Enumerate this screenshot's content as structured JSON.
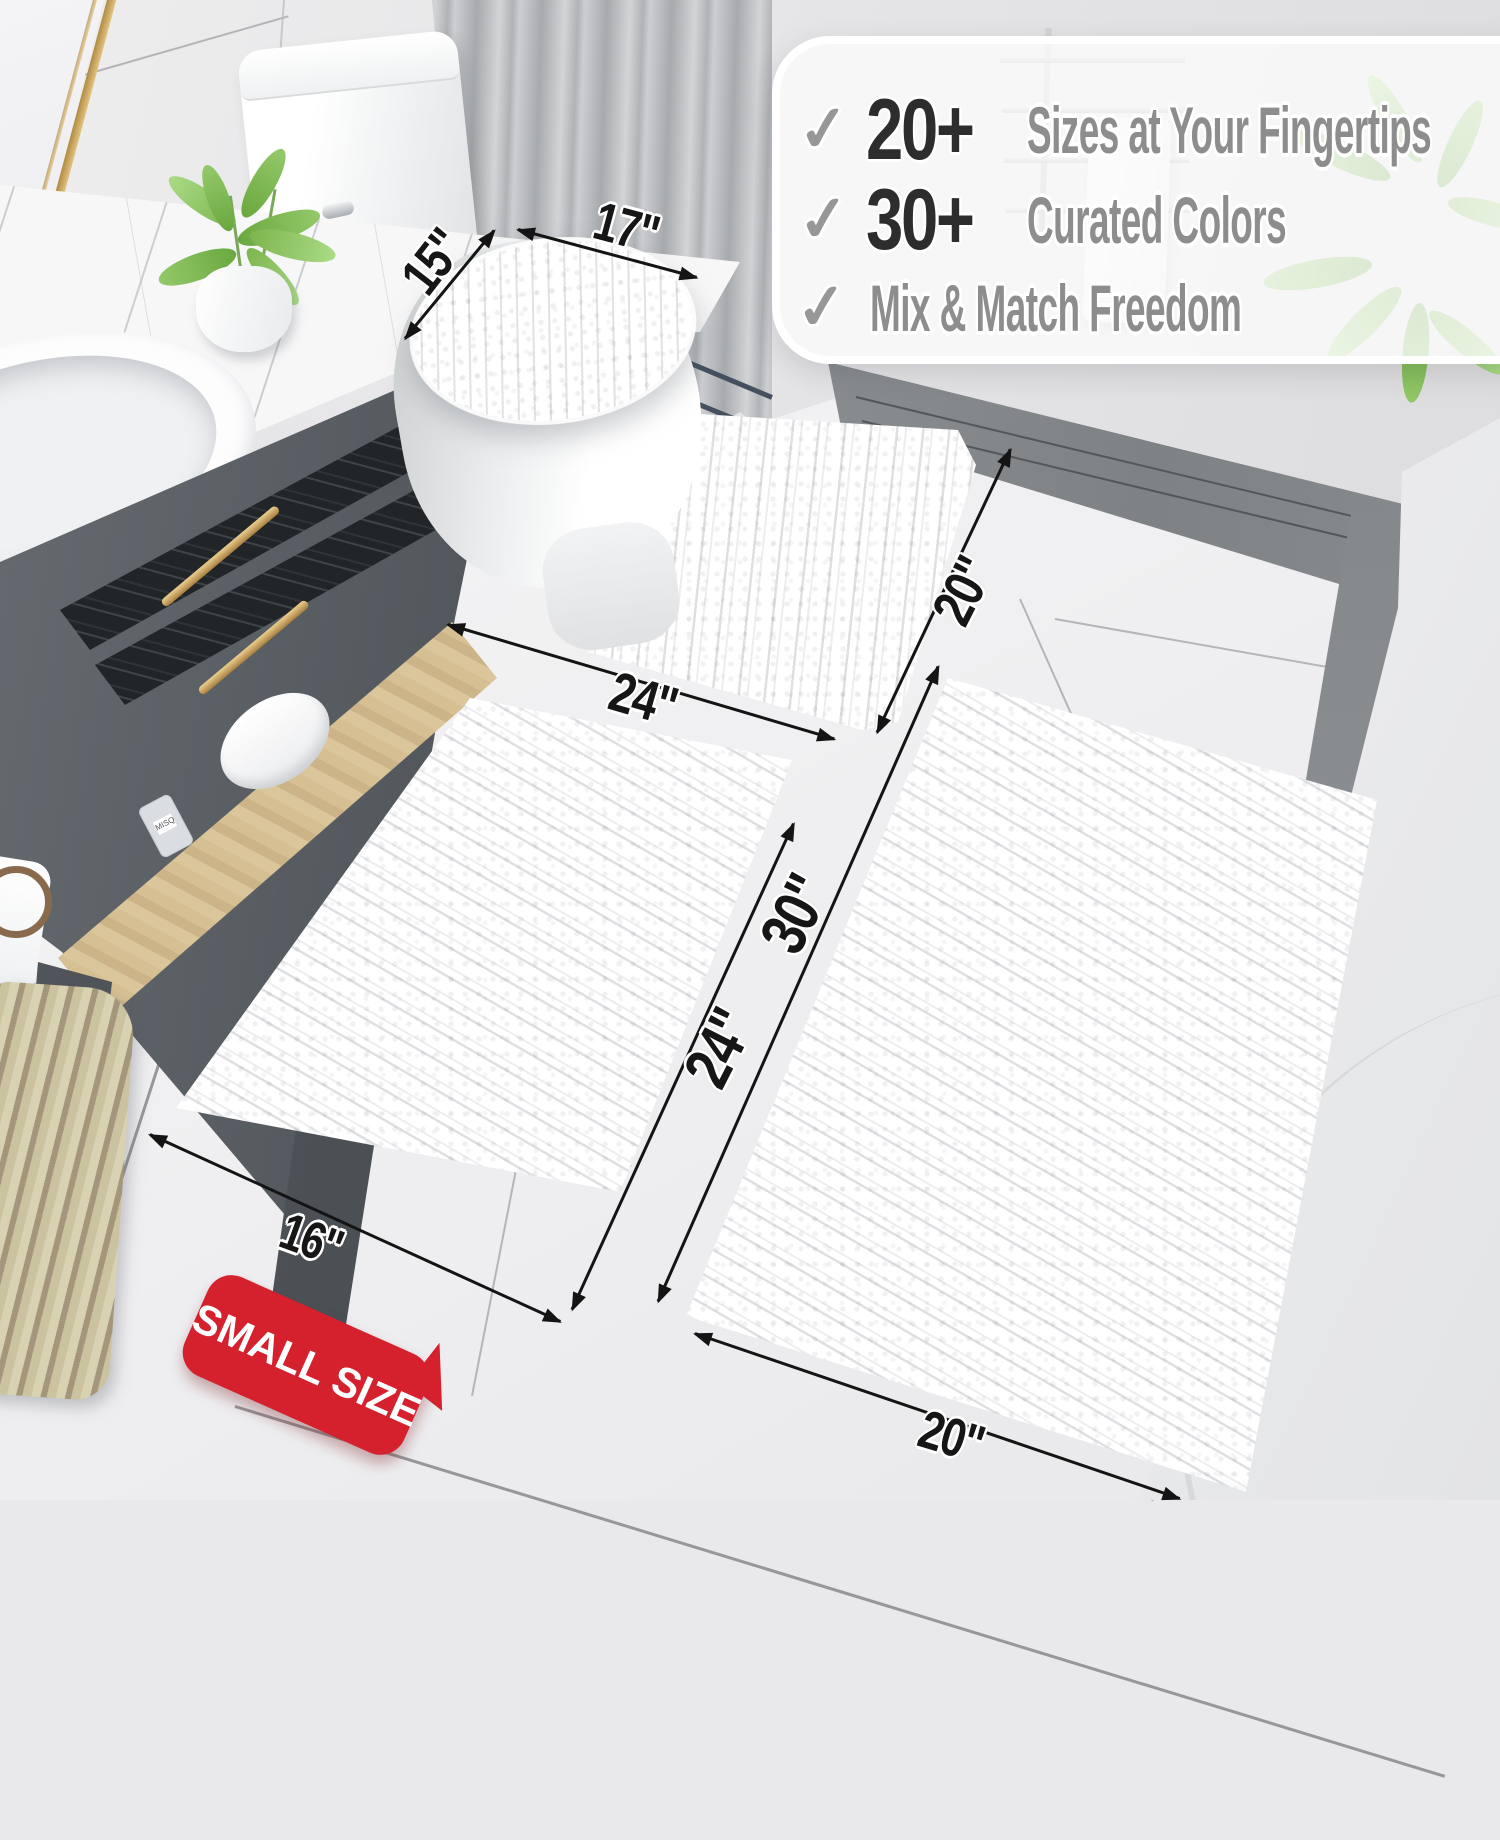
{
  "features": {
    "check_glyph": "✓",
    "items": [
      {
        "icon": "checkmark-icon",
        "number": "20+",
        "text": "Sizes at Your Fingertips"
      },
      {
        "icon": "checkmark-icon",
        "number": "30+",
        "text": "Curated Colors"
      },
      {
        "icon": "checkmark-icon",
        "number": "",
        "text": "Mix & Match Freedom"
      }
    ]
  },
  "dimensions": {
    "lid_width": "15\"",
    "lid_length": "17\"",
    "contour_width": "24\"",
    "contour_depth": "20\"",
    "small_rug_length": "24\"",
    "large_rug_length": "30\"",
    "small_rug_width": "16\"",
    "large_rug_width": "20\""
  },
  "badge": {
    "label": "SMALL SIZE"
  },
  "shelf_bottle": {
    "label": "MISQ"
  },
  "colors": {
    "badge_red": "#d5212e",
    "check_gray": "#979797",
    "number_dark": "#2d2d2d",
    "feature_gray": "#8d8d8d",
    "label_black": "#161616",
    "gold_handle": "#c9a05a",
    "rug_white": "#ffffff"
  }
}
